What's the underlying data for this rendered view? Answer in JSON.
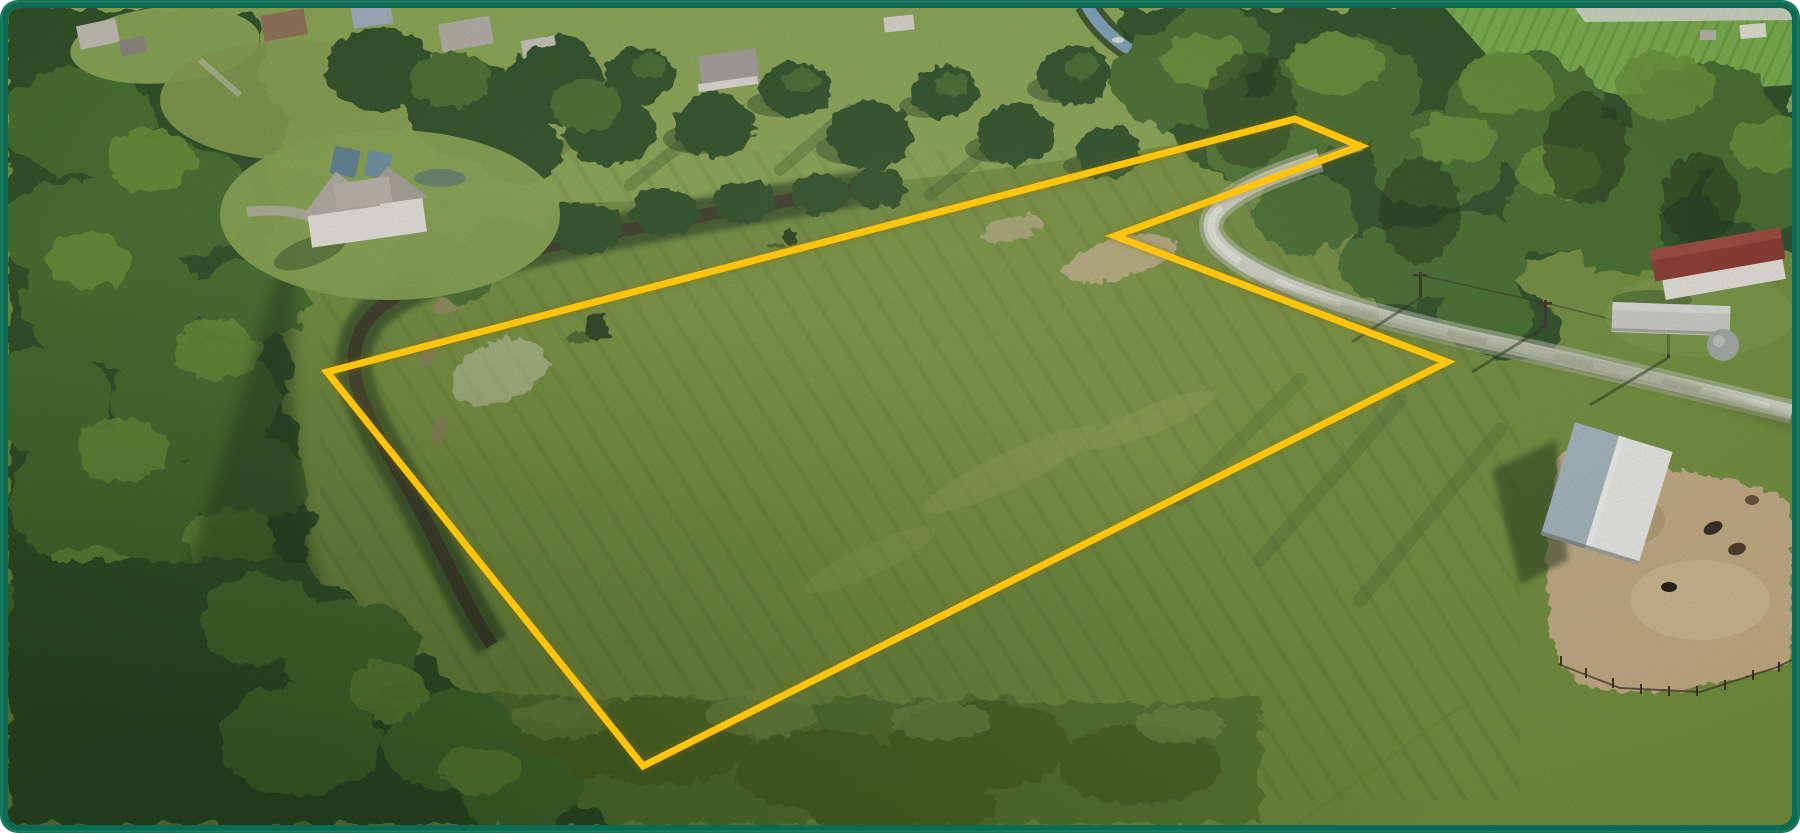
{
  "image": {
    "kind": "aerial-drone-photo",
    "description": "Aerial photo of a grassy vacant land parcel outlined with a yellow lot boundary, bordered by trees, a creek, a curving gravel road, farm buildings and neighboring houses",
    "width": 1800,
    "height": 833
  },
  "frame": {
    "corner_radius": 18,
    "border_width": 8
  },
  "boundary": {
    "stroke_width": 7,
    "points": [
      [
        327,
        372
      ],
      [
        1295,
        119
      ],
      [
        1360,
        146
      ],
      [
        1115,
        236
      ],
      [
        1447,
        362
      ],
      [
        643,
        766
      ]
    ],
    "points_string": "327,372 1295,119 1360,146 1115,236 1447,362 643,766"
  },
  "features": [
    "yellow-lot-boundary",
    "meadow",
    "left-forest",
    "creek",
    "blue-stream",
    "gravel-road",
    "power-poles",
    "gray-house",
    "neighbor-rooftops",
    "red-roof-house",
    "trailer-home",
    "silo",
    "white-barn",
    "dirt-paddock",
    "fence",
    "animals",
    "crop-field",
    "scrub-band"
  ],
  "colors": {
    "frame": "#0C6B53",
    "frameline": "#2E8E6F",
    "field": "#75923F",
    "fieldlight": "#8AA84D",
    "lawn": "#8FAC55",
    "treedark": "#2E5128",
    "treemid": "#47702F",
    "treelight": "#699437",
    "treedeep": "#1C3318",
    "scrub": "#5C7A33",
    "creek": "#3D3A26",
    "creekband": "#304924",
    "stream": "#7FA6BE",
    "streambank": "#27401F",
    "road": "#D7D9CD",
    "roadbright": "#EDEEE5",
    "dirt": "#C8B087",
    "sand": "#DFDCC8",
    "roofred": "#8E3B32",
    "roofgray": "#B4B0A7",
    "wall": "#EBE8E0",
    "barnleft": "#A9BAC2",
    "barnright": "#F0F1EB",
    "trailer": "#D2D3CE",
    "silo": "#A9AEAB",
    "boundary": "#FFC40D",
    "boundaryshadow": "#8A6C00"
  }
}
